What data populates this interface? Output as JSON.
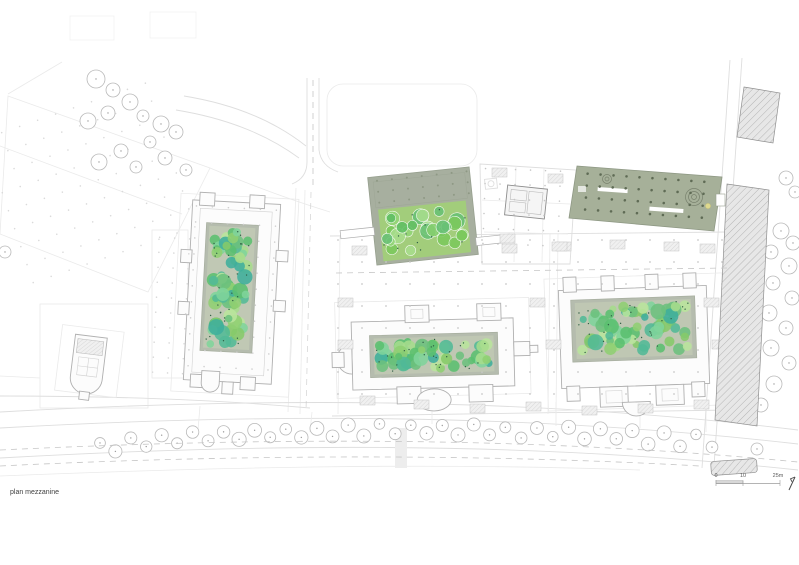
{
  "page": {
    "title": "plan mezzanine",
    "background": "#ffffff"
  },
  "scale_bar": {
    "tick0": "0",
    "tick1": "10",
    "tick2": "25m"
  },
  "colors": {
    "plaza": "#a7af9f",
    "olive_roof": "#a6b099",
    "roof_dot": "#5f6b55",
    "courtyard_frame": "#b5bcae",
    "garden_dot": "#2f5f45",
    "hatch_fill": "#e7e7e7",
    "hatch_line": "#a9a9a9",
    "tree_stroke": "#b9b9b9",
    "tree_dot": "#9c9c9c",
    "palette_courtyard": [
      "#8fcf72",
      "#a6dc8c",
      "#6cc07d",
      "#52b996",
      "#3fae9c",
      "#7fd49b",
      "#b9e59c",
      "#5bbf6f",
      "#86c96a"
    ],
    "palette_plaza": [
      "#7cc95d",
      "#93d677",
      "#5fbf63",
      "#86cf6e",
      "#a8de8d",
      "#69c175"
    ]
  },
  "gardens": [
    {
      "target": "garden-left",
      "x": 206,
      "y": 227,
      "w": 46,
      "h": 122,
      "seed": 11,
      "count": 62,
      "rmin": 3.5,
      "rmax": 8,
      "palette": "palette_courtyard",
      "base": "#c0c8b4",
      "dots": 30,
      "white_stroke": false
    },
    {
      "target": "garden-middle",
      "x": 374,
      "y": 337,
      "w": 120,
      "h": 36,
      "seed": 23,
      "count": 58,
      "rmin": 3.5,
      "rmax": 7.5,
      "palette": "palette_courtyard",
      "base": "#bfc7b3",
      "dots": 26,
      "white_stroke": false
    },
    {
      "target": "garden-right",
      "x": 576,
      "y": 301,
      "w": 116,
      "h": 56,
      "seed": 37,
      "count": 60,
      "rmin": 3.5,
      "rmax": 8,
      "palette": "palette_courtyard",
      "base": "#bfc7b3",
      "dots": 28,
      "white_stroke": false
    },
    {
      "target": "garden-plaza",
      "x": 379,
      "y": 205,
      "w": 88,
      "h": 52,
      "seed": 51,
      "count": 26,
      "rmin": 4.5,
      "rmax": 8.5,
      "palette": "palette_plaza",
      "base": "#a2cd7b",
      "dots": 12,
      "white_stroke": true
    }
  ],
  "grids": [
    {
      "x": 6,
      "y": 104,
      "w": 186,
      "h": 168,
      "sx": 19,
      "sy": 19,
      "rot": -19,
      "color": "#dadada",
      "r": 0.8
    },
    {
      "x": 338,
      "y": 240,
      "w": 386,
      "h": 172,
      "sx": 24,
      "sy": 22,
      "rot": 0,
      "color": "#c9c9c9",
      "r": 0.9
    },
    {
      "x": 192,
      "y": 208,
      "w": 82,
      "h": 168,
      "sx": 16,
      "sy": 16,
      "rot": 3,
      "color": "#cfcfcf",
      "r": 0.8
    },
    {
      "x": 586,
      "y": 178,
      "w": 126,
      "h": 42,
      "sx": 13,
      "sy": 12,
      "rot": 4,
      "color": "#5f6b55",
      "r": 1.3
    },
    {
      "x": 484,
      "y": 170,
      "w": 86,
      "h": 88,
      "sx": 15,
      "sy": 15,
      "rot": 2,
      "color": "#c6c6c6",
      "r": 0.8
    },
    {
      "x": 156,
      "y": 238,
      "w": 30,
      "h": 138,
      "sx": 15,
      "sy": 15,
      "rot": 3,
      "color": "#d8d8d8",
      "r": 0.8
    },
    {
      "x": 378,
      "y": 176,
      "w": 90,
      "h": 24,
      "sx": 15,
      "sy": 11,
      "rot": -6,
      "color": "#8e9884",
      "r": 1.0
    }
  ],
  "cores": {
    "w": 15,
    "h": 9,
    "positions": [
      [
        352,
        246
      ],
      [
        394,
        244
      ],
      [
        448,
        242
      ],
      [
        502,
        244
      ],
      [
        556,
        242
      ],
      [
        610,
        240
      ],
      [
        664,
        242
      ],
      [
        700,
        244
      ],
      [
        338,
        298
      ],
      [
        338,
        340
      ],
      [
        530,
        298
      ],
      [
        546,
        340
      ],
      [
        704,
        298
      ],
      [
        712,
        340
      ],
      [
        360,
        396
      ],
      [
        414,
        400
      ],
      [
        470,
        404
      ],
      [
        526,
        402
      ],
      [
        582,
        406
      ],
      [
        638,
        404
      ],
      [
        694,
        400
      ],
      [
        492,
        168
      ],
      [
        548,
        174
      ],
      [
        500,
        234
      ],
      [
        552,
        242
      ]
    ]
  },
  "trees": {
    "street": {
      "count": 40,
      "p0": [
        100,
        446
      ],
      "p1": [
        400,
        416
      ],
      "p2": [
        712,
        442
      ],
      "r": 6.2,
      "alt": 5
    },
    "topleft": [
      [
        96,
        79,
        9
      ],
      [
        113,
        90,
        7
      ],
      [
        130,
        102,
        8
      ],
      [
        108,
        113,
        7
      ],
      [
        88,
        121,
        8
      ],
      [
        143,
        116,
        6
      ],
      [
        161,
        124,
        8
      ],
      [
        176,
        132,
        7
      ],
      [
        150,
        142,
        6
      ],
      [
        121,
        151,
        7
      ],
      [
        99,
        162,
        8
      ],
      [
        136,
        167,
        6
      ],
      [
        165,
        158,
        7
      ],
      [
        186,
        170,
        6
      ],
      [
        5,
        252,
        6
      ]
    ],
    "right": [
      [
        786,
        178,
        7
      ],
      [
        795,
        192,
        6
      ],
      [
        781,
        231,
        8
      ],
      [
        793,
        243,
        7
      ],
      [
        771,
        252,
        7
      ],
      [
        789,
        266,
        8
      ],
      [
        773,
        283,
        7
      ],
      [
        792,
        298,
        7
      ],
      [
        769,
        313,
        8
      ],
      [
        786,
        328,
        7
      ],
      [
        771,
        348,
        8
      ],
      [
        789,
        363,
        7
      ],
      [
        774,
        384,
        8
      ],
      [
        761,
        405,
        7
      ],
      [
        757,
        449,
        6
      ]
    ]
  }
}
